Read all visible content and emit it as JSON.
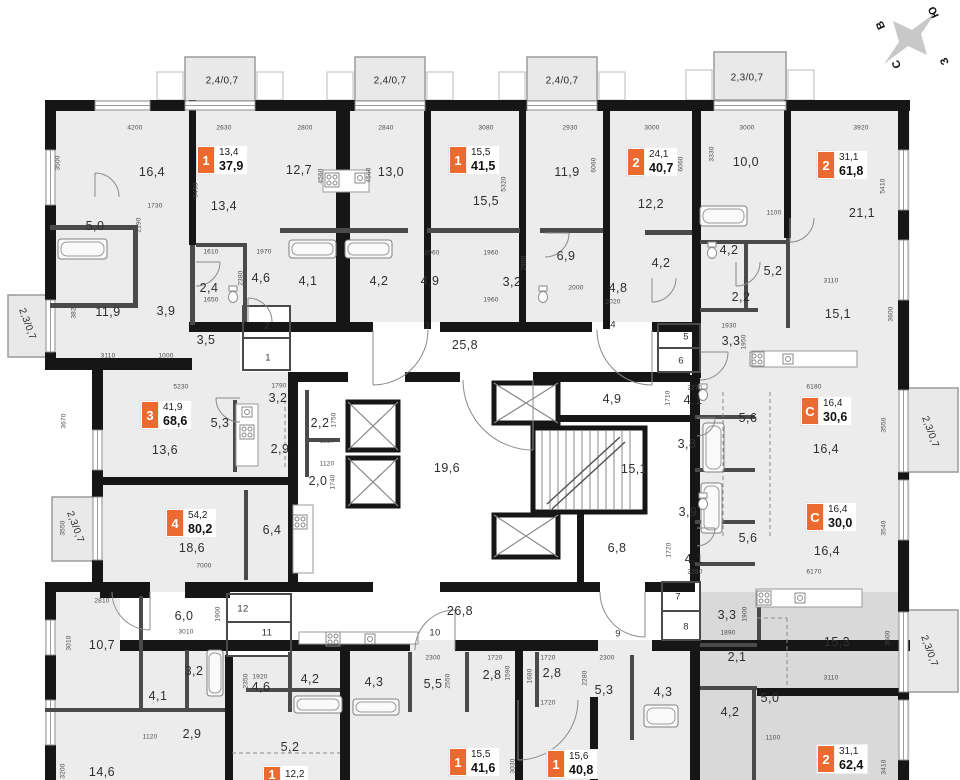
{
  "colors": {
    "badge_orange": "#EA6A2F",
    "wall_black": "#161616",
    "floor_gray": "#ECECEC",
    "highlight_gray": "#D9D9D9"
  },
  "compass": {
    "letters": [
      {
        "t": "В",
        "x": 881,
        "y": 25,
        "r": -115
      },
      {
        "t": "Ю",
        "x": 934,
        "y": 12,
        "r": -115
      },
      {
        "t": "С",
        "x": 897,
        "y": 64,
        "r": -115
      },
      {
        "t": "З",
        "x": 945,
        "y": 61,
        "r": -115
      }
    ]
  },
  "balconies": [
    {
      "t": "2,4/0,7",
      "x": 222,
      "y": 81,
      "r": 0
    },
    {
      "t": "2,4/0,7",
      "x": 390,
      "y": 81,
      "r": 0
    },
    {
      "t": "2,4/0,7",
      "x": 562,
      "y": 81,
      "r": 0
    },
    {
      "t": "2,3/0,7",
      "x": 747,
      "y": 78,
      "r": 0
    },
    {
      "t": "2,3/0,7",
      "x": 27,
      "y": 324,
      "r": 70
    },
    {
      "t": "2,3/0,7",
      "x": 75,
      "y": 527,
      "r": 70
    },
    {
      "t": "2,3/0,7",
      "x": 930,
      "y": 432,
      "r": 70
    },
    {
      "t": "2,3/0,7",
      "x": 929,
      "y": 651,
      "r": 70
    }
  ],
  "badges": [
    {
      "num": "1",
      "a1": "13,4",
      "a2": "37,9",
      "x": 197,
      "y": 146
    },
    {
      "num": "1",
      "a1": "15,5",
      "a2": "41,5",
      "x": 449,
      "y": 146
    },
    {
      "num": "2",
      "a1": "24,1",
      "a2": "40,7",
      "x": 627,
      "y": 148
    },
    {
      "num": "2",
      "a1": "31,1",
      "a2": "61,8",
      "x": 817,
      "y": 151
    },
    {
      "num": "3",
      "a1": "41,9",
      "a2": "68,6",
      "x": 141,
      "y": 401
    },
    {
      "num": "4",
      "a1": "54,2",
      "a2": "80,2",
      "x": 166,
      "y": 509
    },
    {
      "num": "C",
      "a1": "16,4",
      "a2": "30,6",
      "x": 801,
      "y": 397
    },
    {
      "num": "C",
      "a1": "16,4",
      "a2": "30,0",
      "x": 806,
      "y": 503
    },
    {
      "num": "2",
      "a1": "31,1",
      "a2": "62,4",
      "x": 817,
      "y": 745
    },
    {
      "num": "1",
      "a1": "15,5",
      "a2": "41,6",
      "x": 449,
      "y": 748
    },
    {
      "num": "1",
      "a1": "15,6",
      "a2": "40,8",
      "x": 547,
      "y": 750
    },
    {
      "num": "1",
      "a1": "12,2",
      "a2": "",
      "x": 263,
      "y": 766
    }
  ],
  "rooms": [
    {
      "t": "16,4",
      "x": 152,
      "y": 172
    },
    {
      "t": "5,0",
      "x": 95,
      "y": 226
    },
    {
      "t": "11,9",
      "x": 108,
      "y": 312
    },
    {
      "t": "3,9",
      "x": 166,
      "y": 311
    },
    {
      "t": "13,4",
      "x": 224,
      "y": 206
    },
    {
      "t": "2,4",
      "x": 209,
      "y": 288
    },
    {
      "t": "3,5",
      "x": 206,
      "y": 340
    },
    {
      "t": "4,6",
      "x": 261,
      "y": 278
    },
    {
      "t": "12,7",
      "x": 299,
      "y": 170
    },
    {
      "t": "13,0",
      "x": 391,
      "y": 172
    },
    {
      "t": "4,1",
      "x": 308,
      "y": 281
    },
    {
      "t": "4,2",
      "x": 379,
      "y": 281
    },
    {
      "t": "15,5",
      "x": 486,
      "y": 201
    },
    {
      "t": "4,9",
      "x": 430,
      "y": 281
    },
    {
      "t": "3,2",
      "x": 512,
      "y": 282
    },
    {
      "t": "11,9",
      "x": 567,
      "y": 172
    },
    {
      "t": "6,9",
      "x": 566,
      "y": 256
    },
    {
      "t": "4,8",
      "x": 618,
      "y": 288
    },
    {
      "t": "12,2",
      "x": 651,
      "y": 204
    },
    {
      "t": "4,2",
      "x": 661,
      "y": 263
    },
    {
      "t": "10,0",
      "x": 746,
      "y": 162
    },
    {
      "t": "4,2",
      "x": 729,
      "y": 250
    },
    {
      "t": "2,2",
      "x": 741,
      "y": 297
    },
    {
      "t": "5,2",
      "x": 773,
      "y": 271
    },
    {
      "t": "3,3",
      "x": 731,
      "y": 341
    },
    {
      "t": "21,1",
      "x": 862,
      "y": 213
    },
    {
      "t": "15,1",
      "x": 838,
      "y": 314
    },
    {
      "t": "25,8",
      "x": 465,
      "y": 345
    },
    {
      "t": "3,2",
      "x": 278,
      "y": 398
    },
    {
      "t": "13,6",
      "x": 165,
      "y": 450
    },
    {
      "t": "5,3",
      "x": 220,
      "y": 423
    },
    {
      "t": "2,9",
      "x": 280,
      "y": 449
    },
    {
      "t": "2,2",
      "x": 320,
      "y": 423
    },
    {
      "t": "2,0",
      "x": 318,
      "y": 481
    },
    {
      "t": "19,6",
      "x": 447,
      "y": 468
    },
    {
      "t": "4,9",
      "x": 612,
      "y": 399
    },
    {
      "t": "15,1",
      "x": 634,
      "y": 469
    },
    {
      "t": "4,1",
      "x": 693,
      "y": 400
    },
    {
      "t": "3,8",
      "x": 687,
      "y": 444
    },
    {
      "t": "5,6",
      "x": 748,
      "y": 418
    },
    {
      "t": "16,4",
      "x": 826,
      "y": 449
    },
    {
      "t": "3,9",
      "x": 688,
      "y": 512
    },
    {
      "t": "5,6",
      "x": 748,
      "y": 538
    },
    {
      "t": "16,4",
      "x": 827,
      "y": 551
    },
    {
      "t": "4,1",
      "x": 694,
      "y": 559
    },
    {
      "t": "18,6",
      "x": 192,
      "y": 548
    },
    {
      "t": "6,4",
      "x": 272,
      "y": 530
    },
    {
      "t": "6,8",
      "x": 617,
      "y": 548
    },
    {
      "t": "26,8",
      "x": 460,
      "y": 611
    },
    {
      "t": "6,0",
      "x": 184,
      "y": 616
    },
    {
      "t": "10,7",
      "x": 102,
      "y": 645
    },
    {
      "t": "3,2",
      "x": 194,
      "y": 671
    },
    {
      "t": "4,1",
      "x": 158,
      "y": 696
    },
    {
      "t": "2,9",
      "x": 192,
      "y": 734
    },
    {
      "t": "14,6",
      "x": 102,
      "y": 772
    },
    {
      "t": "4,6",
      "x": 261,
      "y": 687
    },
    {
      "t": "4,2",
      "x": 310,
      "y": 679
    },
    {
      "t": "4,3",
      "x": 374,
      "y": 682
    },
    {
      "t": "5,5",
      "x": 433,
      "y": 684
    },
    {
      "t": "2,8",
      "x": 492,
      "y": 675
    },
    {
      "t": "5,2",
      "x": 290,
      "y": 747
    },
    {
      "t": "2,8",
      "x": 552,
      "y": 673
    },
    {
      "t": "5,3",
      "x": 604,
      "y": 690
    },
    {
      "t": "4,3",
      "x": 663,
      "y": 692
    },
    {
      "t": "2,1",
      "x": 737,
      "y": 657
    },
    {
      "t": "4,2",
      "x": 730,
      "y": 712
    },
    {
      "t": "3,3",
      "x": 727,
      "y": 615
    },
    {
      "t": "15,3",
      "x": 837,
      "y": 642
    },
    {
      "t": "5,0",
      "x": 770,
      "y": 698
    }
  ],
  "doors": [
    {
      "t": "2",
      "x": 267,
      "y": 326
    },
    {
      "t": "1",
      "x": 268,
      "y": 358
    },
    {
      "t": "3",
      "x": 427,
      "y": 326
    },
    {
      "t": "4",
      "x": 613,
      "y": 325
    },
    {
      "t": "5",
      "x": 686,
      "y": 337
    },
    {
      "t": "6",
      "x": 681,
      "y": 361
    },
    {
      "t": "7",
      "x": 678,
      "y": 597
    },
    {
      "t": "8",
      "x": 686,
      "y": 627
    },
    {
      "t": "9",
      "x": 618,
      "y": 634
    },
    {
      "t": "10",
      "x": 435,
      "y": 633
    },
    {
      "t": "11",
      "x": 267,
      "y": 633
    },
    {
      "t": "12",
      "x": 243,
      "y": 609
    }
  ],
  "dims": [
    {
      "t": "4200",
      "x": 135,
      "y": 128
    },
    {
      "t": "2630",
      "x": 224,
      "y": 128
    },
    {
      "t": "2800",
      "x": 305,
      "y": 128
    },
    {
      "t": "2840",
      "x": 386,
      "y": 128
    },
    {
      "t": "3080",
      "x": 486,
      "y": 128
    },
    {
      "t": "2930",
      "x": 570,
      "y": 128
    },
    {
      "t": "3000",
      "x": 652,
      "y": 128
    },
    {
      "t": "3000",
      "x": 747,
      "y": 128
    },
    {
      "t": "3920",
      "x": 861,
      "y": 128
    },
    {
      "t": "3500",
      "x": 58,
      "y": 163,
      "v": 1
    },
    {
      "t": "5460",
      "x": 196,
      "y": 190,
      "v": 1
    },
    {
      "t": "1730",
      "x": 155,
      "y": 206
    },
    {
      "t": "2190",
      "x": 139,
      "y": 225,
      "v": 1
    },
    {
      "t": "1610",
      "x": 211,
      "y": 252
    },
    {
      "t": "1970",
      "x": 264,
      "y": 252
    },
    {
      "t": "4560",
      "x": 321,
      "y": 176,
      "v": 1
    },
    {
      "t": "4560",
      "x": 369,
      "y": 175,
      "v": 1
    },
    {
      "t": "5320",
      "x": 504,
      "y": 184,
      "v": 1
    },
    {
      "t": "2060",
      "x": 432,
      "y": 253
    },
    {
      "t": "1960",
      "x": 491,
      "y": 253
    },
    {
      "t": "6060",
      "x": 594,
      "y": 165,
      "v": 1
    },
    {
      "t": "6060",
      "x": 681,
      "y": 164,
      "v": 1
    },
    {
      "t": "3330",
      "x": 712,
      "y": 154,
      "v": 1
    },
    {
      "t": "5410",
      "x": 883,
      "y": 186,
      "v": 1
    },
    {
      "t": "1100",
      "x": 774,
      "y": 213
    },
    {
      "t": "3820",
      "x": 74,
      "y": 311,
      "v": 1
    },
    {
      "t": "3110",
      "x": 108,
      "y": 356
    },
    {
      "t": "1000",
      "x": 166,
      "y": 356
    },
    {
      "t": "1450",
      "x": 193,
      "y": 288,
      "v": 1
    },
    {
      "t": "1650",
      "x": 211,
      "y": 300
    },
    {
      "t": "2380",
      "x": 241,
      "y": 278,
      "v": 1
    },
    {
      "t": "2900",
      "x": 524,
      "y": 263,
      "v": 1
    },
    {
      "t": "2000",
      "x": 576,
      "y": 288
    },
    {
      "t": "2020",
      "x": 613,
      "y": 302
    },
    {
      "t": "1960",
      "x": 491,
      "y": 300
    },
    {
      "t": "3110",
      "x": 831,
      "y": 281
    },
    {
      "t": "3600",
      "x": 891,
      "y": 314,
      "v": 1
    },
    {
      "t": "1930",
      "x": 729,
      "y": 326
    },
    {
      "t": "1950",
      "x": 744,
      "y": 342,
      "v": 1
    },
    {
      "t": "5230",
      "x": 181,
      "y": 387
    },
    {
      "t": "1790",
      "x": 279,
      "y": 386
    },
    {
      "t": "3670",
      "x": 64,
      "y": 421,
      "v": 1
    },
    {
      "t": "3550",
      "x": 63,
      "y": 528,
      "v": 1
    },
    {
      "t": "7000",
      "x": 204,
      "y": 566
    },
    {
      "t": "1750",
      "x": 334,
      "y": 420,
      "v": 1
    },
    {
      "t": "1120",
      "x": 327,
      "y": 441
    },
    {
      "t": "1120",
      "x": 327,
      "y": 464
    },
    {
      "t": "1740",
      "x": 333,
      "y": 482,
      "v": 1
    },
    {
      "t": "6180",
      "x": 814,
      "y": 387
    },
    {
      "t": "2270",
      "x": 695,
      "y": 388
    },
    {
      "t": "1710",
      "x": 668,
      "y": 398,
      "v": 1
    },
    {
      "t": "3550",
      "x": 884,
      "y": 425,
      "v": 1
    },
    {
      "t": "3540",
      "x": 884,
      "y": 528,
      "v": 1
    },
    {
      "t": "6170",
      "x": 814,
      "y": 572
    },
    {
      "t": "2280",
      "x": 695,
      "y": 572
    },
    {
      "t": "1720",
      "x": 669,
      "y": 550,
      "v": 1
    },
    {
      "t": "2810",
      "x": 102,
      "y": 601
    },
    {
      "t": "3010",
      "x": 69,
      "y": 643,
      "v": 1
    },
    {
      "t": "3010",
      "x": 186,
      "y": 632
    },
    {
      "t": "1900",
      "x": 218,
      "y": 614,
      "v": 1
    },
    {
      "t": "3200",
      "x": 63,
      "y": 771,
      "v": 1
    },
    {
      "t": "1920",
      "x": 260,
      "y": 677
    },
    {
      "t": "2350",
      "x": 246,
      "y": 681,
      "v": 1
    },
    {
      "t": "1120",
      "x": 150,
      "y": 737
    },
    {
      "t": "2300",
      "x": 433,
      "y": 658
    },
    {
      "t": "1720",
      "x": 495,
      "y": 658
    },
    {
      "t": "1720",
      "x": 548,
      "y": 658
    },
    {
      "t": "2300",
      "x": 607,
      "y": 658
    },
    {
      "t": "2550",
      "x": 448,
      "y": 681,
      "v": 1
    },
    {
      "t": "1590",
      "x": 508,
      "y": 673,
      "v": 1
    },
    {
      "t": "1680",
      "x": 530,
      "y": 676,
      "v": 1
    },
    {
      "t": "2280",
      "x": 585,
      "y": 678,
      "v": 1
    },
    {
      "t": "1720",
      "x": 548,
      "y": 703
    },
    {
      "t": "3030",
      "x": 513,
      "y": 766,
      "v": 1
    },
    {
      "t": "1890",
      "x": 728,
      "y": 633
    },
    {
      "t": "1900",
      "x": 745,
      "y": 614,
      "v": 1
    },
    {
      "t": "3600",
      "x": 888,
      "y": 638,
      "v": 1
    },
    {
      "t": "3110",
      "x": 831,
      "y": 678
    },
    {
      "t": "1100",
      "x": 773,
      "y": 738
    },
    {
      "t": "3410",
      "x": 884,
      "y": 767,
      "v": 1
    }
  ]
}
